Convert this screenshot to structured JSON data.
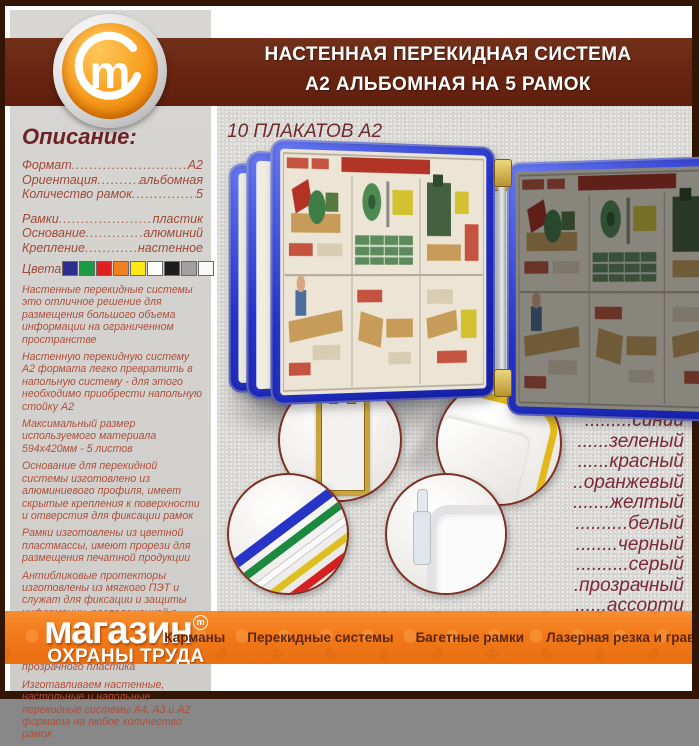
{
  "header": {
    "line1": "НАСТЕННАЯ ПЕРЕКИДНАЯ СИСТЕМА",
    "line2": "А2 АЛЬБОМНАЯ НА 5 РАМОК"
  },
  "logo": {
    "letter": "m"
  },
  "sidebar": {
    "title": "Описание:",
    "specs": [
      {
        "label": "Формат",
        "value": "А2"
      },
      {
        "label": "Ориентация",
        "value": "альбомная"
      },
      {
        "label": "Количество рамок",
        "value": "5"
      },
      {
        "label": "Рамки",
        "value": "пластик"
      },
      {
        "label": "Основание",
        "value": "алюминий"
      },
      {
        "label": "Крепление",
        "value": "настенное"
      }
    ],
    "colors_label": "Цвета",
    "swatches": [
      "#2b2e8f",
      "#1d9b44",
      "#e02020",
      "#f08020",
      "#ffe818",
      "#ffffff",
      "#1c1c1c",
      "#a0a0a0",
      "#f8f8f8"
    ],
    "paragraphs": [
      "Настенные перекидные системы это отличное решение для размещения большого объема информации на ограниченном пространстве",
      "Настенную перекидную систему А2 формата легко превратить в напольную систему - для этого необходимо приобрести напольную стойку А2",
      "Максимальный размер используемого материала 594х420мм - 5 листов",
      "Основание для перекидной системы изготовлено из алюминиевого профиля, имеет скрытые крепления к поверхности и отверстия для фиксации рамок",
      "Рамки изготовлены из цветной пластмассы, имеют прорези для размещения печатной продукции",
      "Антибликовые протекторы изготовлены из мягкого ПЭТ и служат для фиксации и защиты информации, расположенной в пластиковой рамке А2 формата",
      "Держатели рамки для перекидной системы изготовлены из прозрачного пластика",
      "Изготавливаем настенные, настольные и напольные перекидные системы А4, А3 и А2 формата на любое количество рамок"
    ]
  },
  "main": {
    "subtitle": "10 ПЛАКАТОВ А2",
    "color_list": [
      ".........синий",
      "......зеленый",
      "......красный",
      "..оранжевый",
      ".......желтый",
      "..........белый",
      "........черный",
      "..........серый",
      ".прозрачный",
      "......ассорти"
    ]
  },
  "brand": {
    "name": "магазин",
    "mark": "m",
    "sub": "ОХРАНЫ ТРУДА"
  },
  "footer": {
    "items": [
      "Карманы",
      "Перекидные системы",
      "Багетные рамки",
      "Лазерная резка и гравировка"
    ]
  },
  "colors": {
    "accent_orange": "#f2791a",
    "band_maroon": "#682411",
    "border_brown": "#331505",
    "frame_blue": "#2433cc",
    "text_red": "#ae4f3a",
    "text_maroon": "#7b2936"
  }
}
